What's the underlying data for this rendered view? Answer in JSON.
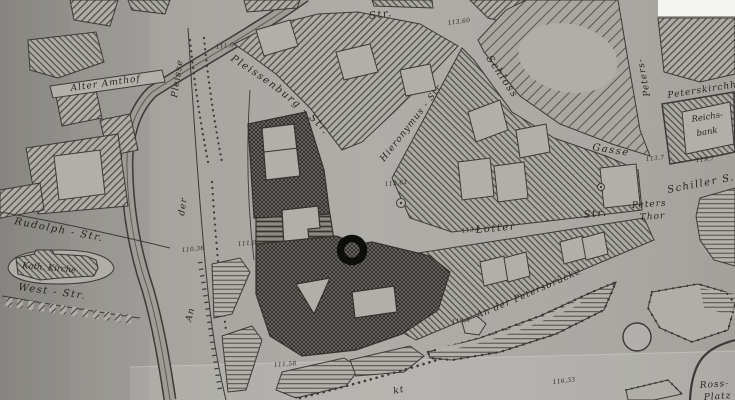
{
  "colors": {
    "paper": "#a9a7a2",
    "ink": "#33322e",
    "marker": "#0d0d0c"
  },
  "marker": {
    "name": "ring-marker"
  },
  "streets": {
    "alter_amthof": "Alter Amthof",
    "pleisse": "Pleisse",
    "der": "der",
    "an": "An",
    "pleissenburg": "Pleissenburg - Str.",
    "top_str": "- Str.",
    "hieronymus": "Hieronymus - Str",
    "schloss": "Schloss",
    "gasse": "Gasse",
    "peters": "Peters-",
    "peterskirchhof": "Peterskirchh.",
    "schiller": "Schiller S.",
    "peters_thor_1": "Peters",
    "peters_thor_2": "Thor",
    "lotter": "Lotter",
    "lotter_dash": "-",
    "lotter_str": "Str.",
    "petersbruecke": "An der Petersbrücke",
    "rudolph": "Rudolph - Str.",
    "west": "West - Str.",
    "markt_fragment": "kt",
    "ross_1": "Ross-",
    "ross_2": "Platz"
  },
  "places": {
    "kath_kirche": "Kath. Kirche",
    "reichsbank_1": "Reichs-",
    "reichsbank_2": "bank"
  },
  "elevations": {
    "e1": "111,0",
    "e2": "113,60",
    "e3": "112,61",
    "e4": "110,36",
    "e5": "111,0",
    "e6": "113,0",
    "e7": "113,7",
    "e8": "119,7",
    "e9": "111,58",
    "e10": "119,4",
    "e11": "116,33"
  }
}
